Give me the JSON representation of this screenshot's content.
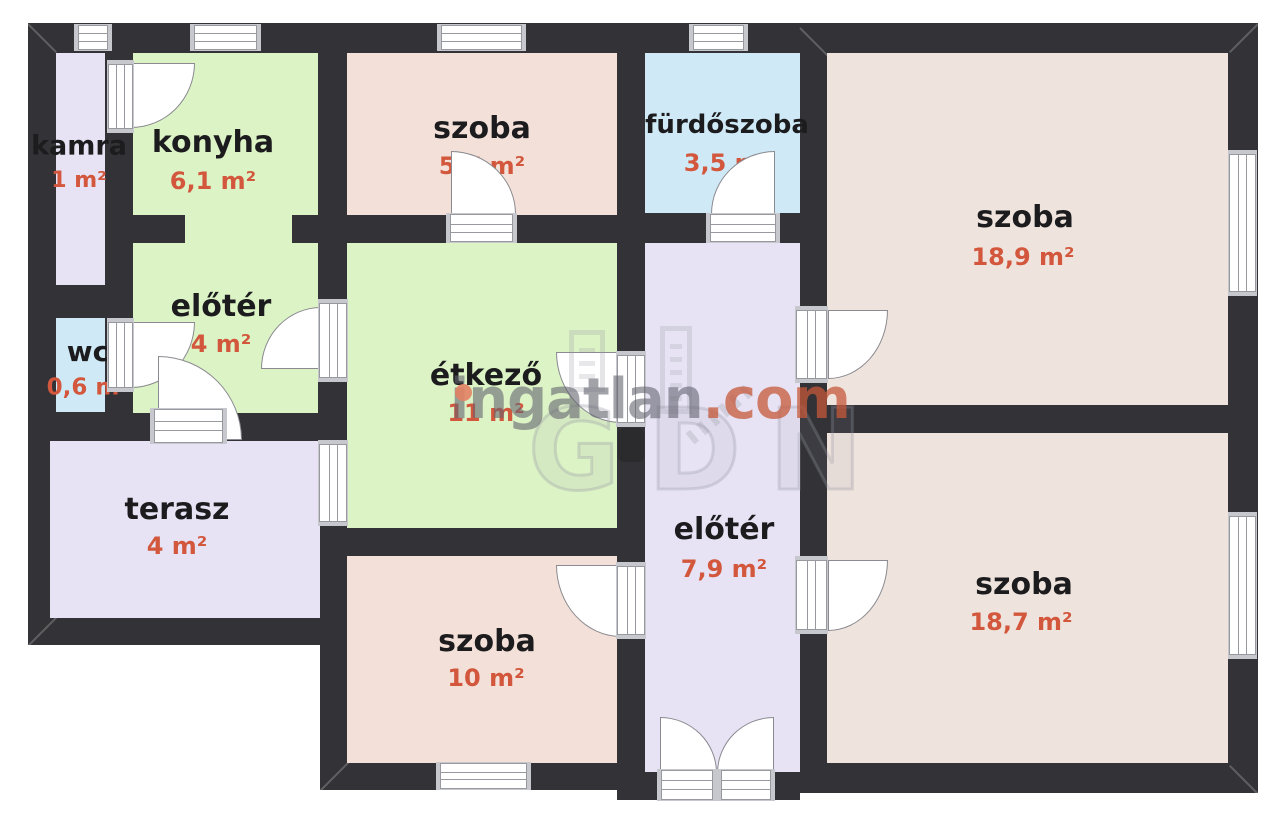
{
  "canvas": {
    "width": 1280,
    "height": 826,
    "background": "#ffffff"
  },
  "palette": {
    "wall": "#333337",
    "green": "#dcf3c6",
    "lavender": "#e7e3f4",
    "blue": "#cfeaf6",
    "pink_small": "#f3e1d9",
    "pink_big": "#efe4dd",
    "name_text": "#1c1c1e",
    "area_text": "#d2573c",
    "frame_cap": "#c7c7ce",
    "frame_line": "#98989f",
    "watermark_gray": "#64646f",
    "watermark_orange": "#c6583a"
  },
  "rooms": [
    {
      "id": "kamra",
      "name": "kamra",
      "area": "1 m²",
      "color": "lavender",
      "rects": [
        [
          56,
          53,
          49,
          232
        ]
      ],
      "label": {
        "nx": 79,
        "ny": 146,
        "ax": 79,
        "ay": 181
      },
      "name_size": 27,
      "area_size": 22
    },
    {
      "id": "konyha",
      "name": "konyha",
      "area": "6,1 m²",
      "color": "green",
      "rects": [
        [
          133,
          53,
          185,
          162
        ],
        [
          185,
          215,
          107,
          29
        ]
      ],
      "label": {
        "nx": 213,
        "ny": 143,
        "ax": 213,
        "ay": 181
      },
      "name_size": 30,
      "area_size": 24
    },
    {
      "id": "eloter-felso",
      "name": "előtér",
      "area": "4 m²",
      "color": "green",
      "rects": [
        [
          133,
          243,
          185,
          170
        ]
      ],
      "label": {
        "nx": 221,
        "ny": 307,
        "ax": 221,
        "ay": 344
      },
      "name_size": 30,
      "area_size": 24
    },
    {
      "id": "wc",
      "name": "wc",
      "area": "0,6 m²",
      "color": "blue",
      "rects": [
        [
          56,
          318,
          49,
          94
        ]
      ],
      "label": {
        "nx": 88,
        "ny": 352,
        "ax": 88,
        "ay": 388
      },
      "name_size": 28,
      "area_size": 23
    },
    {
      "id": "szoba-57",
      "name": "szoba",
      "area": "5,7 m²",
      "color": "pink_small",
      "rects": [
        [
          347,
          53,
          270,
          162
        ]
      ],
      "label": {
        "nx": 482,
        "ny": 129,
        "ax": 482,
        "ay": 166
      },
      "name_size": 30,
      "area_size": 24
    },
    {
      "id": "furdoszoba",
      "name": "fürdőszoba",
      "area": "3,5 m²",
      "color": "blue",
      "rects": [
        [
          645,
          53,
          155,
          160
        ]
      ],
      "label": {
        "nx": 727,
        "ny": 125,
        "ax": 727,
        "ay": 163
      },
      "name_size": 26,
      "area_size": 24
    },
    {
      "id": "szoba-189",
      "name": "szoba",
      "area": "18,9 m²",
      "color": "pink_big",
      "rects": [
        [
          827,
          53,
          401,
          352
        ]
      ],
      "label": {
        "nx": 1025,
        "ny": 218,
        "ax": 1023,
        "ay": 257
      },
      "name_size": 30,
      "area_size": 24
    },
    {
      "id": "etkezo",
      "name": "étkező",
      "area": "11 m²",
      "color": "green",
      "rects": [
        [
          347,
          243,
          270,
          285
        ]
      ],
      "label": {
        "nx": 486,
        "ny": 376,
        "ax": 486,
        "ay": 413
      },
      "name_size": 30,
      "area_size": 24
    },
    {
      "id": "eloter-also",
      "name": "előtér",
      "area": "7,9 m²",
      "color": "lavender",
      "rects": [
        [
          645,
          243,
          155,
          529
        ]
      ],
      "label": {
        "nx": 724,
        "ny": 530,
        "ax": 724,
        "ay": 569
      },
      "name_size": 30,
      "area_size": 24
    },
    {
      "id": "terasz",
      "name": "terasz",
      "area": "4 m²",
      "color": "lavender",
      "rects": [
        [
          50,
          441,
          270,
          177
        ]
      ],
      "label": {
        "nx": 177,
        "ny": 510,
        "ax": 177,
        "ay": 546
      },
      "name_size": 30,
      "area_size": 24
    },
    {
      "id": "szoba-10",
      "name": "szoba",
      "area": "10 m²",
      "color": "pink_small",
      "rects": [
        [
          347,
          556,
          270,
          207
        ]
      ],
      "label": {
        "nx": 487,
        "ny": 642,
        "ax": 486,
        "ay": 678
      },
      "name_size": 30,
      "area_size": 24
    },
    {
      "id": "szoba-187",
      "name": "szoba",
      "area": "18,7 m²",
      "color": "pink_big",
      "rects": [
        [
          827,
          433,
          401,
          330
        ]
      ],
      "label": {
        "nx": 1024,
        "ny": 585,
        "ax": 1021,
        "ay": 622
      },
      "name_size": 30,
      "area_size": 24
    }
  ],
  "walls": [
    [
      28,
      23,
      617,
      417
    ],
    [
      320,
      243,
      325,
      547
    ],
    [
      28,
      413,
      319,
      232
    ],
    [
      617,
      23,
      641,
      770
    ],
    [
      617,
      763,
      183,
      37
    ]
  ],
  "windows": [
    [
      74,
      24,
      38,
      27,
      "h"
    ],
    [
      190,
      24,
      71,
      27,
      "h"
    ],
    [
      437,
      24,
      89,
      27,
      "h"
    ],
    [
      689,
      24,
      59,
      27,
      "h"
    ],
    [
      1228,
      150,
      29,
      146,
      "v"
    ],
    [
      1228,
      512,
      29,
      147,
      "v"
    ],
    [
      436,
      762,
      95,
      28,
      "h"
    ],
    [
      318,
      440,
      30,
      86,
      "v"
    ]
  ],
  "door_frames": [
    [
      107,
      60,
      27,
      73,
      "v"
    ],
    [
      107,
      318,
      27,
      74,
      "v"
    ],
    [
      446,
      213,
      71,
      30,
      "h"
    ],
    [
      706,
      213,
      74,
      30,
      "h"
    ],
    [
      318,
      299,
      30,
      83,
      "v"
    ],
    [
      150,
      408,
      77,
      36,
      "h"
    ],
    [
      616,
      351,
      30,
      76,
      "v"
    ],
    [
      795,
      306,
      33,
      77,
      "v"
    ],
    [
      795,
      556,
      33,
      78,
      "v"
    ],
    [
      616,
      562,
      30,
      77,
      "v"
    ],
    [
      657,
      769,
      60,
      32,
      "h"
    ],
    [
      717,
      769,
      58,
      32,
      "h"
    ]
  ],
  "door_leaves": [
    [
      131,
      63,
      64,
      65,
      "br"
    ],
    [
      131,
      322,
      64,
      66,
      "br"
    ],
    [
      451,
      151,
      65,
      63,
      "tr"
    ],
    [
      711,
      151,
      64,
      63,
      "tl"
    ],
    [
      261,
      307,
      60,
      62,
      "tl"
    ],
    [
      158,
      356,
      84,
      84,
      "tr"
    ],
    [
      556,
      352,
      65,
      71,
      "bl"
    ],
    [
      828,
      310,
      60,
      69,
      "br"
    ],
    [
      828,
      560,
      60,
      71,
      "br"
    ],
    [
      556,
      565,
      65,
      72,
      "bl"
    ],
    [
      660,
      717,
      57,
      56,
      "tr"
    ],
    [
      717,
      717,
      57,
      56,
      "tl"
    ]
  ],
  "objects": [
    {
      "type": "radiator",
      "rect": [
        618,
        428,
        26,
        34
      ]
    }
  ],
  "bevels": [
    {
      "x": 28,
      "y": 23,
      "deg": 45
    },
    {
      "x": 1258,
      "y": 23,
      "deg": 135
    },
    {
      "x": 1258,
      "y": 793,
      "deg": 225
    },
    {
      "x": 28,
      "y": 645,
      "deg": -45
    },
    {
      "x": 320,
      "y": 790,
      "deg": -45
    },
    {
      "x": 800,
      "y": 27,
      "deg": 45
    }
  ],
  "watermark": {
    "brand_gray": "ingatlan",
    "brand_orange": ".com",
    "ghost_letters": "GDN"
  }
}
